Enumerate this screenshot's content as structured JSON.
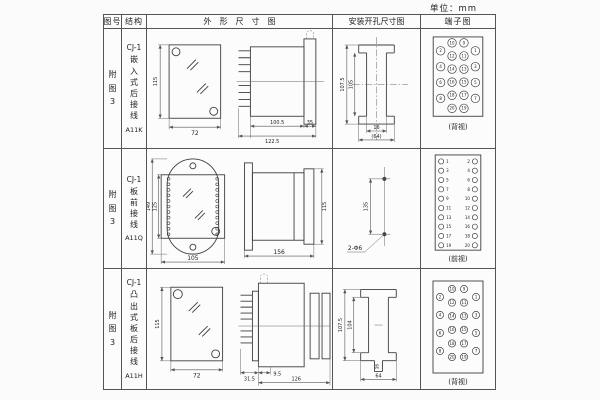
{
  "unit_label": "单位：mm",
  "table": {
    "headers": {
      "figure_no": "图号",
      "structure": "结构",
      "outline": "外形尺寸图",
      "install": "安装开孔尺寸图",
      "terminal": "端子图"
    },
    "rows": [
      {
        "figure_no": "附图3",
        "structure": {
          "model": "CJ-1",
          "mounting": "嵌入式后接线",
          "code": "A11K"
        },
        "outline": {
          "height": "115",
          "width": "72",
          "depth_body": "100.5",
          "depth_total": "122.5",
          "flange": "35"
        },
        "install": {
          "outer_height": "107.5",
          "inner_height": "105",
          "slot_width": "16",
          "overall_width": "(64)"
        },
        "terminal": {
          "view_label": "(背视)"
        }
      },
      {
        "figure_no": "附图3",
        "structure": {
          "model": "CJ-1",
          "mounting": "板前接线",
          "code": "A11Q"
        },
        "outline": {
          "outer_height": "149",
          "inner_height": "125",
          "width": "105",
          "depth": "156",
          "side_height": "115"
        },
        "install": {
          "hole_spacing": "135",
          "holes": "2-Φ6"
        },
        "terminal": {
          "view_label": "(前视)"
        }
      },
      {
        "figure_no": "附图3",
        "structure": {
          "model": "CJ-1",
          "mounting": "凸出式板后接线",
          "code": "A11H"
        },
        "outline": {
          "height": "115",
          "width": "72",
          "pin_depth": "31.5",
          "offset": "9.5",
          "depth_total": "126"
        },
        "install": {
          "outer_height": "107.5",
          "inner_height": "104",
          "slot_width": "16",
          "overall_width": "64"
        },
        "terminal": {
          "view_label": "(背视)"
        }
      }
    ]
  },
  "terminal_numbers": {
    "rear": {
      "outer_left": [
        2,
        4,
        6,
        8
      ],
      "mid_left": [
        10,
        12,
        14,
        16,
        18,
        20
      ],
      "mid_right": [
        9,
        11,
        13,
        15,
        17,
        19
      ],
      "outer_right": [
        1,
        3,
        5,
        7
      ]
    },
    "front": {
      "left": [
        1,
        3,
        5,
        7,
        9,
        11,
        13,
        15,
        17,
        19
      ],
      "right": [
        2,
        4,
        6,
        8,
        10,
        12,
        14,
        16,
        18,
        20
      ]
    }
  }
}
